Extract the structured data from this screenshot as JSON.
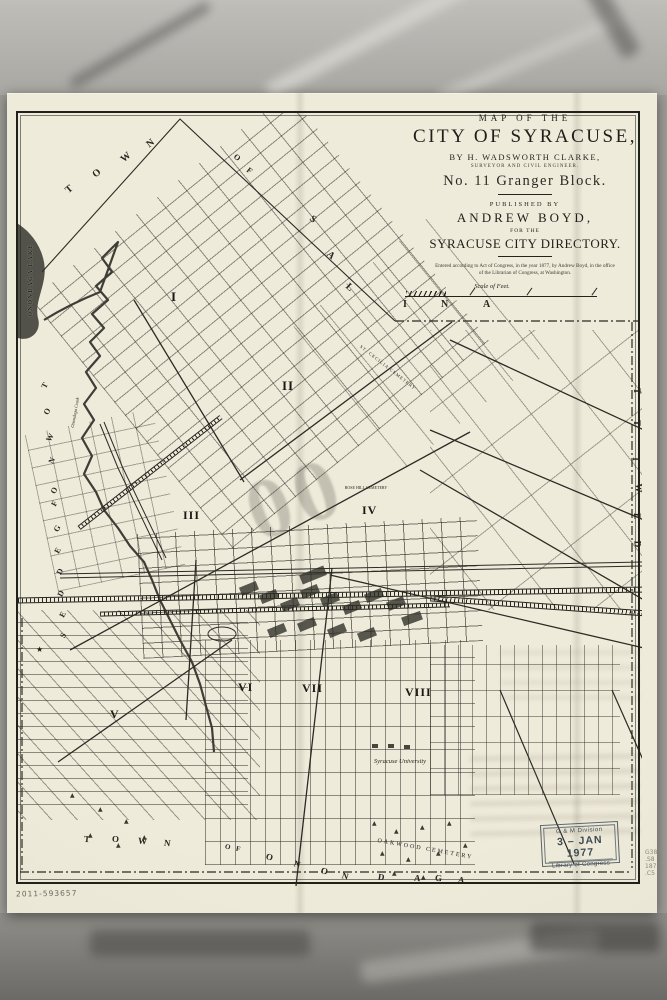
{
  "colors": {
    "paper": "#ece8d8",
    "ink": "#23231c",
    "stamp_ink": "#3d4a54",
    "lake": "#53524a",
    "backdrop": "#9e9c97"
  },
  "title_block": {
    "line1": "MAP OF THE",
    "line2": "CITY OF SYRACUSE,",
    "line3": "BY H. WADSWORTH CLARKE,",
    "line4": "SURVEYOR AND CIVIL ENGINEER.",
    "line5": "No. 11 Granger Block.",
    "line6": "PUBLISHED BY",
    "line7": "ANDREW BOYD,",
    "line8": "FOR THE",
    "line9": "SYRACUSE CITY DIRECTORY.",
    "copyright1": "Entered according to Act of Congress, in the year 1877, by Andrew Boyd, in the office",
    "copyright2": "of the Librarian of Congress, at Washington."
  },
  "scale_label": "Scale of Feet.",
  "wards": [
    "I",
    "II",
    "III",
    "IV",
    "V",
    "VI",
    "VII",
    "VIII"
  ],
  "letters": {
    "salina": [
      "T",
      "O",
      "W",
      "N",
      "O",
      "F",
      "S",
      "A",
      "L",
      "I",
      "N",
      "A"
    ],
    "geddes": [
      "T",
      "O",
      "W",
      "N",
      "O",
      "F",
      "G",
      "E",
      "D",
      "D",
      "E",
      "S"
    ],
    "dewitt": [
      "T",
      "T",
      "I",
      "W",
      "E",
      "D"
    ],
    "onondaga": [
      "T",
      "O",
      "W",
      "N",
      "O",
      "F",
      "O",
      "N",
      "O",
      "N",
      "D",
      "A",
      "G",
      "A"
    ]
  },
  "places": {
    "lake": "ONONDAGA LAKE",
    "creek": "Onondaga Creek",
    "st_cecilia": "ST. CECILIA CEMETERY",
    "rose_hill": "ROSE HILL CEMETERY",
    "university": "Syracuse University",
    "oakwood": "OAKWOOD CEMETERY"
  },
  "embossed": "00",
  "stamp": {
    "division": "G & M Division",
    "date": "3 – JAN 1977",
    "org": "Library of Congress"
  },
  "margin": {
    "accession": "2011-593657",
    "call_number": [
      "G380",
      ".S8",
      "1877",
      ".C5"
    ]
  },
  "icons": {
    "tree": "▲",
    "star": "★"
  }
}
